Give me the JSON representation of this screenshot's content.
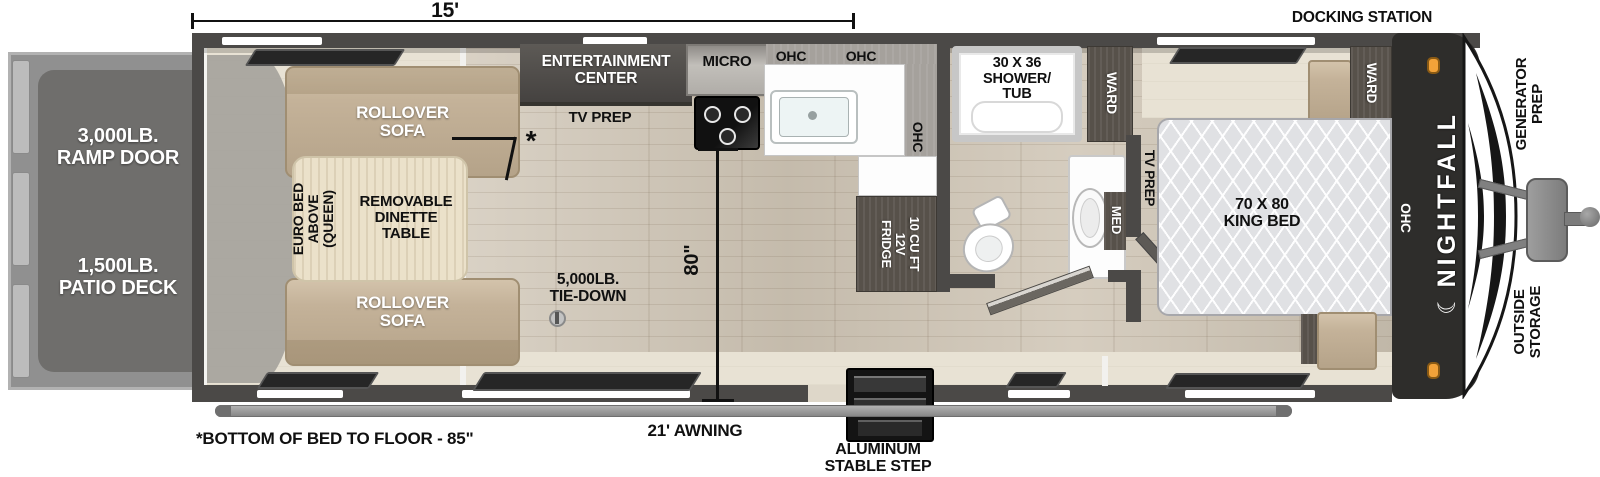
{
  "title": "Nightfall toy hauler floorplan",
  "dimensions": {
    "length_label": "15'",
    "height_label": "80\"",
    "awning_label": "21' AWNING",
    "bed_note": "*BOTTOM OF BED TO FLOOR - 85\"",
    "tie_down": "5,000LB.\nTIE-DOWN",
    "step_label": "ALUMINUM\nSTABLE STEP"
  },
  "exterior": {
    "docking": "DOCKING STATION",
    "generator": "GENERATOR\nPREP",
    "storage": "OUTSIDE\nSTORAGE",
    "brand": "NIGHTFALL",
    "moon": "☾"
  },
  "ramp": {
    "door": "3,000LB.\nRAMP DOOR",
    "deck": "1,500LB.\nPATIO DECK"
  },
  "garage": {
    "sofa_top": "ROLLOVER\nSOFA",
    "sofa_bottom": "ROLLOVER\nSOFA",
    "euro_bed": "EURO BED\nABOVE\n(QUEEN)",
    "dinette": "REMOVABLE\nDINETTE\nTABLE",
    "asterisk": "*"
  },
  "kitchen": {
    "entertainment": "ENTERTAINMENT\nCENTER",
    "tv_prep": "TV PREP",
    "micro": "MICRO",
    "ohc_1": "OHC",
    "ohc_2": "OHC",
    "ohc_side": "OHC",
    "fridge": "10 CU FT\n12V\nFRIDGE"
  },
  "bath": {
    "shower": "30 X 36\nSHOWER/\nTUB",
    "ward": "WARD",
    "med": "MED",
    "tv_prep": "TV PREP"
  },
  "bedroom": {
    "bed": "70 X 80\nKING BED",
    "ward": "WARD",
    "ohc": "OHC"
  },
  "colors": {
    "wall": "#4b4947",
    "floor": "#cfc5b5",
    "cream": "#e8e2d4",
    "tan": "#c4b299",
    "darkwood": "#57514a",
    "orange": "#f2a239",
    "rampgray": "#909090"
  }
}
